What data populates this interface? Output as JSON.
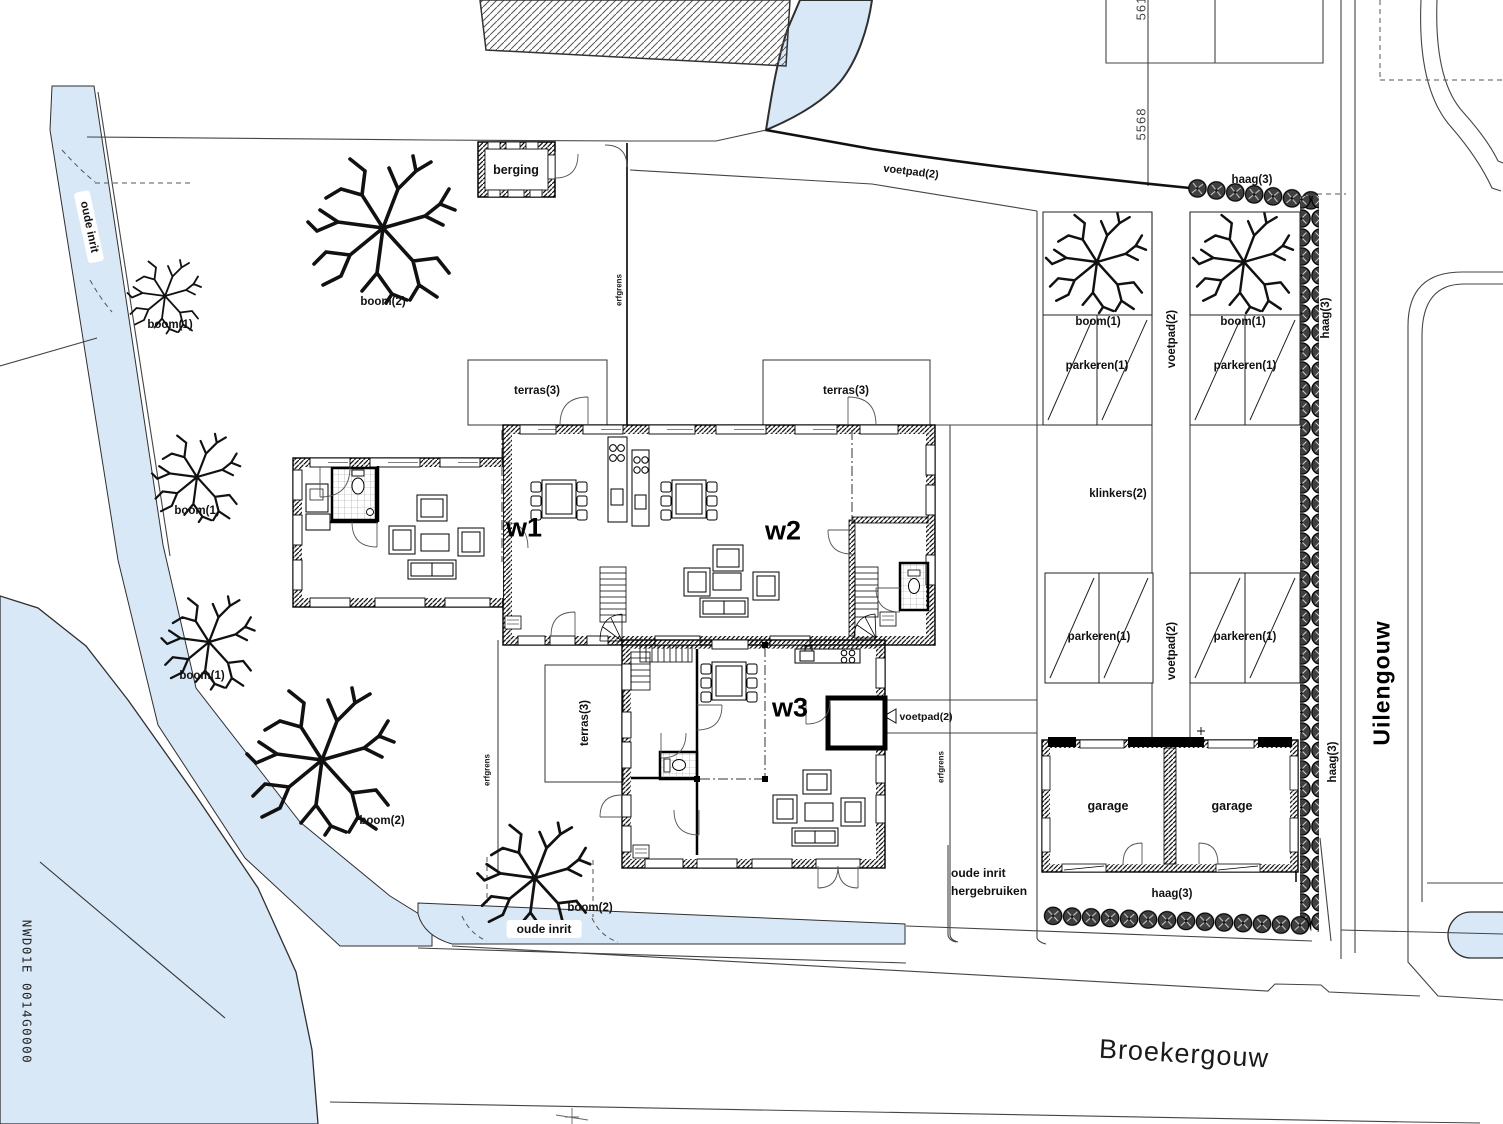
{
  "drawing": {
    "houses": {
      "w1": "w1",
      "w2": "w2",
      "w3": "w3"
    },
    "labels": {
      "berging": "berging",
      "boom1": "boom(1)",
      "boom2": "boom(2)",
      "haag": "haag(3)",
      "voetpad": "voetpad(2)",
      "parkeren": "parkeren(1)",
      "klinkers": "klinkers(2)",
      "terras": "terras(3)",
      "erfgrens": "erfgrens",
      "garage": "garage",
      "oude_inrit": "oude inrit",
      "hergebruiken_line1": "oude inrit",
      "hergebruiken_line2": "hergebruiken"
    },
    "streets": {
      "uilengouw": "Uilengouw",
      "broekergouw": "Broekergouw"
    },
    "parcel_numbers": {
      "top": "561",
      "middle": "5568"
    },
    "cadastral_reference": "NWD01E 0014G0000",
    "colors": {
      "water": "#d9e8f7",
      "hedge": "#3a3a3a",
      "line": "#1a1a1a"
    }
  }
}
